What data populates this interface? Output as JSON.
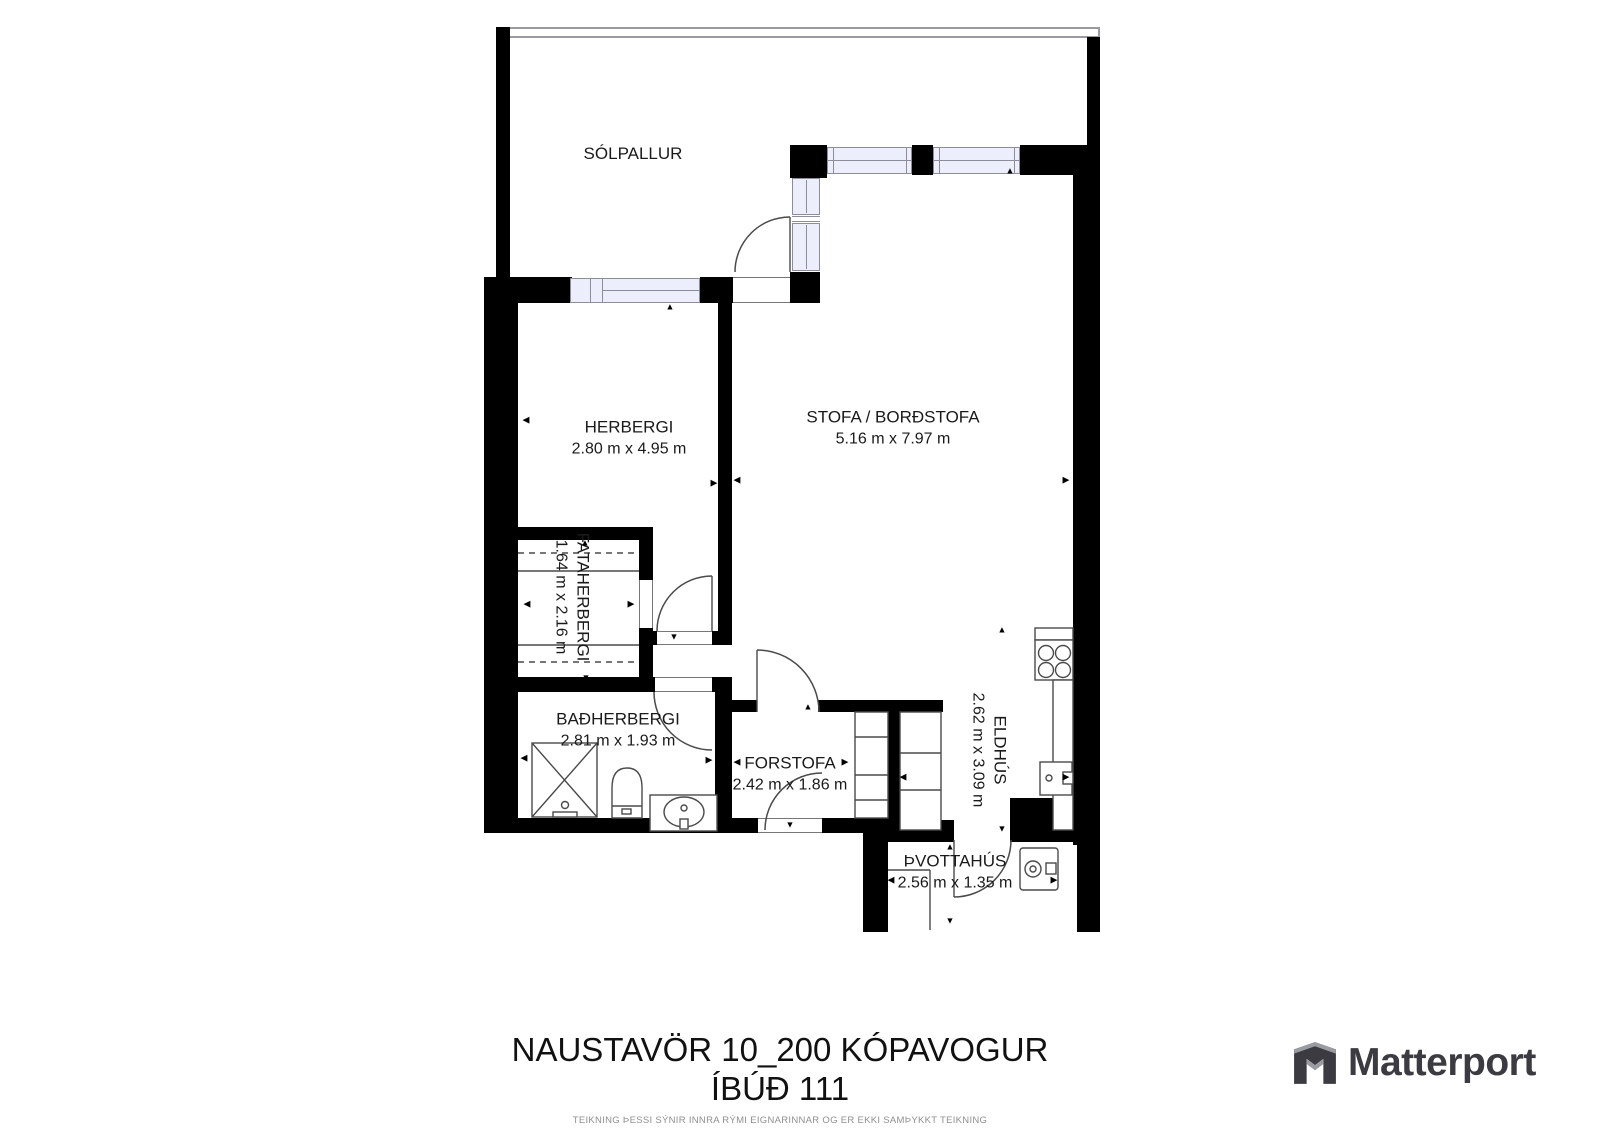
{
  "title": {
    "line1": "NAUSTAVÖR 10_200 KÓPAVOGUR",
    "line2": "ÍBÚÐ 111",
    "disclaimer": "TEIKNING ÞESSI SÝNIR INNRA RÝMI EIGNARINNAR OG ER EKKI SAMÞYKKT TEIKNING"
  },
  "brand": {
    "logo_text": "Matterport",
    "logo_icon": "matterport-cube-icon"
  },
  "colors": {
    "wall": "#000000",
    "window_fill": "#eceefb",
    "window_border": "#8d8d99",
    "stroke": "#4a4a4a",
    "label": "#1a1a1a",
    "disclaimer_text": "#8f8f8f",
    "logo": "#3b3b41",
    "logo_accent": "#9b9ba3"
  },
  "rooms": [
    {
      "id": "solpallur",
      "name": "SÓLPALLUR",
      "dims": "",
      "x": 633,
      "y": 154,
      "rot": 0
    },
    {
      "id": "herbergi",
      "name": "HERBERGI",
      "dims": "2.80 m x 4.95 m",
      "x": 629,
      "y": 438,
      "rot": 0
    },
    {
      "id": "stofa",
      "name": "STOFA / BORÐSTOFA",
      "dims": "5.16 m x 7.97 m",
      "x": 893,
      "y": 428,
      "rot": 0
    },
    {
      "id": "fataherbergi",
      "name": "FATAHERBERGI",
      "dims": "1.64 m x 2.16 m",
      "x": 572,
      "y": 597,
      "rot": 90
    },
    {
      "id": "badherbergi",
      "name": "BAÐHERBERGI",
      "dims": "2.81 m x 1.93 m",
      "x": 618,
      "y": 730,
      "rot": 0
    },
    {
      "id": "forstofa",
      "name": "FORSTOFA",
      "dims": "2.42 m x 1.86 m",
      "x": 790,
      "y": 774,
      "rot": 0
    },
    {
      "id": "eldhus",
      "name": "ELDHÚS",
      "dims": "2.62 m x 3.09 m",
      "x": 989,
      "y": 750,
      "rot": 90
    },
    {
      "id": "thvottahus",
      "name": "ÞVOTTAHÚS",
      "dims": "2.56 m x 1.35 m",
      "x": 955,
      "y": 872,
      "rot": 0
    }
  ],
  "plan": {
    "railing": {
      "x": 496,
      "y": 27,
      "w": 604,
      "h": 11
    },
    "walls": [
      {
        "x": 496,
        "y": 27,
        "w": 14,
        "h": 253
      },
      {
        "x": 1087,
        "y": 37,
        "w": 13,
        "h": 112
      },
      {
        "x": 484,
        "y": 277,
        "w": 34,
        "h": 556
      },
      {
        "x": 484,
        "y": 277,
        "w": 88,
        "h": 26
      },
      {
        "x": 700,
        "y": 277,
        "w": 33,
        "h": 26
      },
      {
        "x": 718,
        "y": 303,
        "w": 14,
        "h": 330
      },
      {
        "x": 645,
        "y": 631,
        "w": 87,
        "h": 14
      },
      {
        "x": 500,
        "y": 527,
        "w": 153,
        "h": 13
      },
      {
        "x": 639,
        "y": 540,
        "w": 14,
        "h": 40
      },
      {
        "x": 639,
        "y": 628,
        "w": 14,
        "h": 49
      },
      {
        "x": 500,
        "y": 677,
        "w": 155,
        "h": 15
      },
      {
        "x": 712,
        "y": 677,
        "w": 20,
        "h": 15
      },
      {
        "x": 715,
        "y": 692,
        "w": 17,
        "h": 128
      },
      {
        "x": 790,
        "y": 145,
        "w": 37,
        "h": 33
      },
      {
        "x": 912,
        "y": 145,
        "w": 21,
        "h": 30
      },
      {
        "x": 1020,
        "y": 145,
        "w": 80,
        "h": 30
      },
      {
        "x": 1073,
        "y": 145,
        "w": 27,
        "h": 700
      },
      {
        "x": 1077,
        "y": 845,
        "w": 23,
        "h": 87
      },
      {
        "x": 790,
        "y": 272,
        "w": 30,
        "h": 31
      },
      {
        "x": 732,
        "y": 700,
        "w": 25,
        "h": 12
      },
      {
        "x": 818,
        "y": 700,
        "w": 125,
        "h": 12
      },
      {
        "x": 888,
        "y": 712,
        "w": 12,
        "h": 110
      },
      {
        "x": 484,
        "y": 818,
        "w": 396,
        "h": 15
      },
      {
        "x": 863,
        "y": 810,
        "w": 25,
        "h": 122
      },
      {
        "x": 888,
        "y": 820,
        "w": 66,
        "h": 22
      },
      {
        "x": 1010,
        "y": 798,
        "w": 63,
        "h": 44
      }
    ],
    "windows": [
      {
        "x": 570,
        "y": 278,
        "w": 130,
        "h": 25
      },
      {
        "x": 827,
        "y": 147,
        "w": 85,
        "h": 27
      },
      {
        "x": 933,
        "y": 147,
        "w": 87,
        "h": 27
      },
      {
        "x": 792,
        "y": 178,
        "w": 28,
        "h": 37
      },
      {
        "x": 792,
        "y": 223,
        "w": 28,
        "h": 48
      }
    ],
    "window_lines": [
      {
        "x": 590,
        "y": 278,
        "w": 1,
        "h": 25
      },
      {
        "x": 602,
        "y": 278,
        "w": 1,
        "h": 25
      },
      {
        "x": 602,
        "y": 290,
        "w": 98,
        "h": 1
      },
      {
        "x": 833,
        "y": 147,
        "w": 1,
        "h": 27
      },
      {
        "x": 906,
        "y": 147,
        "w": 1,
        "h": 27
      },
      {
        "x": 827,
        "y": 160,
        "w": 85,
        "h": 1
      },
      {
        "x": 939,
        "y": 147,
        "w": 1,
        "h": 27
      },
      {
        "x": 1014,
        "y": 147,
        "w": 1,
        "h": 27
      },
      {
        "x": 933,
        "y": 160,
        "w": 87,
        "h": 1
      },
      {
        "x": 806,
        "y": 180,
        "w": 1,
        "h": 33
      },
      {
        "x": 806,
        "y": 225,
        "w": 1,
        "h": 44
      },
      {
        "x": 792,
        "y": 216,
        "w": 28,
        "h": 1
      },
      {
        "x": 792,
        "y": 221,
        "w": 28,
        "h": 1
      }
    ],
    "thresholds": [
      {
        "x": 657,
        "y": 631,
        "w": 55,
        "h": 14,
        "o": "h"
      },
      {
        "x": 655,
        "y": 677,
        "w": 57,
        "h": 15,
        "o": "h"
      },
      {
        "x": 758,
        "y": 818,
        "w": 64,
        "h": 15,
        "o": "h"
      },
      {
        "x": 639,
        "y": 580,
        "w": 14,
        "h": 48,
        "o": "v"
      },
      {
        "x": 733,
        "y": 277,
        "w": 57,
        "h": 26,
        "o": "h"
      }
    ],
    "arcs": [
      {
        "d": "M735,272 A55,55 0 0 1 790,217"
      },
      {
        "d": "M657,631 A55,55 0 0 1 712,576"
      },
      {
        "d": "M654,692 A58,58 0 0 0 712,750"
      },
      {
        "d": "M757,650 A62,62 0 0 1 819,712"
      },
      {
        "d": "M765,830 A57,57 0 0 1 822,773"
      },
      {
        "d": "M1011,840 A57,57 0 0 1 954,897"
      }
    ],
    "fixtures": [
      {
        "t": "line",
        "x1": 790,
        "y1": 217,
        "x2": 790,
        "y2": 272
      },
      {
        "t": "line",
        "x1": 712,
        "y1": 576,
        "x2": 712,
        "y2": 631
      },
      {
        "t": "line",
        "x1": 757,
        "y1": 650,
        "x2": 757,
        "y2": 712
      },
      {
        "t": "line",
        "x1": 954,
        "y1": 840,
        "x2": 954,
        "y2": 897
      },
      {
        "t": "rect",
        "x": 532,
        "y": 743,
        "w": 65,
        "h": 74,
        "f": "none"
      },
      {
        "t": "line",
        "x1": 532,
        "y1": 743,
        "x2": 597,
        "y2": 817
      },
      {
        "t": "line",
        "x1": 597,
        "y1": 743,
        "x2": 532,
        "y2": 817
      },
      {
        "t": "circle",
        "cx": 565,
        "cy": 805,
        "r": 3.5,
        "f": "#fff"
      },
      {
        "t": "rect",
        "x": 553,
        "y": 812,
        "w": 24,
        "h": 5,
        "f": "#fff"
      },
      {
        "t": "path",
        "d": "M612,818 L612,788 Q612,768 627,768 Q642,768 642,788 L642,818 Z",
        "f": "#fff"
      },
      {
        "t": "line",
        "x1": 612,
        "y1": 806,
        "x2": 642,
        "y2": 806
      },
      {
        "t": "rect",
        "x": 622,
        "y": 809,
        "w": 9,
        "h": 5,
        "f": "#fff"
      },
      {
        "t": "rect",
        "x": 650,
        "y": 795,
        "w": 67,
        "h": 36,
        "f": "#fff"
      },
      {
        "t": "ellipse",
        "cx": 684,
        "cy": 812,
        "rx": 20,
        "ry": 15,
        "f": "#fff"
      },
      {
        "t": "circle",
        "cx": 684,
        "cy": 808,
        "r": 3,
        "f": "#fff"
      },
      {
        "t": "rect",
        "x": 680,
        "y": 819,
        "w": 8,
        "h": 10,
        "f": "#fff"
      },
      {
        "t": "rect",
        "x": 1035,
        "y": 628,
        "w": 38,
        "h": 12,
        "f": "#fff"
      },
      {
        "t": "rect",
        "x": 1035,
        "y": 640,
        "w": 38,
        "h": 40,
        "f": "#fff"
      },
      {
        "t": "circle",
        "cx": 1046,
        "cy": 653,
        "r": 7.5,
        "f": "#fff"
      },
      {
        "t": "circle",
        "cx": 1063,
        "cy": 653,
        "r": 7.5,
        "f": "#fff"
      },
      {
        "t": "circle",
        "cx": 1046,
        "cy": 670,
        "r": 7.5,
        "f": "#fff"
      },
      {
        "t": "circle",
        "cx": 1063,
        "cy": 670,
        "r": 7.5,
        "f": "#fff"
      },
      {
        "t": "rect",
        "x": 1053,
        "y": 680,
        "w": 20,
        "h": 150,
        "f": "#fff"
      },
      {
        "t": "rect",
        "x": 1040,
        "y": 762,
        "w": 32,
        "h": 33,
        "f": "#fff"
      },
      {
        "t": "circle",
        "cx": 1049,
        "cy": 778,
        "r": 3,
        "f": "#fff"
      },
      {
        "t": "rect",
        "x": 1063,
        "y": 772,
        "w": 10,
        "h": 12,
        "f": "#fff"
      },
      {
        "t": "rect",
        "x": 900,
        "y": 712,
        "w": 41,
        "h": 118,
        "f": "#fff"
      },
      {
        "t": "line",
        "x1": 900,
        "y1": 753,
        "x2": 941,
        "y2": 753
      },
      {
        "t": "line",
        "x1": 900,
        "y1": 790,
        "x2": 941,
        "y2": 790
      },
      {
        "t": "rect",
        "x": 855,
        "y": 712,
        "w": 33,
        "h": 106,
        "f": "#fff"
      },
      {
        "t": "line",
        "x1": 855,
        "y1": 737,
        "x2": 888,
        "y2": 737
      },
      {
        "t": "line",
        "x1": 855,
        "y1": 775,
        "x2": 888,
        "y2": 775
      },
      {
        "t": "line",
        "x1": 855,
        "y1": 800,
        "x2": 888,
        "y2": 800
      },
      {
        "t": "rect",
        "x": 1020,
        "y": 848,
        "w": 38,
        "h": 42,
        "rx": 3,
        "f": "#fff"
      },
      {
        "t": "circle",
        "cx": 1033,
        "cy": 869,
        "r": 8,
        "f": "#fff"
      },
      {
        "t": "circle",
        "cx": 1033,
        "cy": 869,
        "r": 3,
        "f": "#fff"
      },
      {
        "t": "rect",
        "x": 1046,
        "y": 863,
        "w": 10,
        "h": 11,
        "f": "#fff"
      },
      {
        "t": "line",
        "x1": 888,
        "y1": 870,
        "x2": 930,
        "y2": 870
      },
      {
        "t": "line",
        "x1": 930,
        "y1": 870,
        "x2": 930,
        "y2": 930
      },
      {
        "t": "line",
        "x1": 518,
        "y1": 553,
        "x2": 639,
        "y2": 553,
        "dash": "6,5"
      },
      {
        "t": "line",
        "x1": 518,
        "y1": 571,
        "x2": 639,
        "y2": 571
      },
      {
        "t": "line",
        "x1": 518,
        "y1": 645,
        "x2": 639,
        "y2": 645
      },
      {
        "t": "line",
        "x1": 518,
        "y1": 662,
        "x2": 639,
        "y2": 662,
        "dash": "6,5"
      }
    ],
    "arrows": [
      {
        "g": "up",
        "x": 670,
        "y": 307
      },
      {
        "g": "up",
        "x": 1010,
        "y": 171
      },
      {
        "g": "up",
        "x": 808,
        "y": 707
      },
      {
        "g": "up",
        "x": 950,
        "y": 847
      },
      {
        "g": "up",
        "x": 1002,
        "y": 630
      },
      {
        "g": "up",
        "x": 585,
        "y": 543
      },
      {
        "g": "down",
        "x": 674,
        "y": 637
      },
      {
        "g": "down",
        "x": 790,
        "y": 825
      },
      {
        "g": "down",
        "x": 950,
        "y": 921
      },
      {
        "g": "down",
        "x": 1002,
        "y": 829
      },
      {
        "g": "down",
        "x": 586,
        "y": 678
      },
      {
        "g": "left",
        "x": 526,
        "y": 420
      },
      {
        "g": "left",
        "x": 527,
        "y": 604
      },
      {
        "g": "left",
        "x": 737,
        "y": 480
      },
      {
        "g": "left",
        "x": 524,
        "y": 758
      },
      {
        "g": "left",
        "x": 737,
        "y": 762
      },
      {
        "g": "left",
        "x": 891,
        "y": 880
      },
      {
        "g": "left",
        "x": 903,
        "y": 777
      },
      {
        "g": "right",
        "x": 714,
        "y": 483
      },
      {
        "g": "right",
        "x": 631,
        "y": 604
      },
      {
        "g": "right",
        "x": 1066,
        "y": 480
      },
      {
        "g": "right",
        "x": 709,
        "y": 760
      },
      {
        "g": "right",
        "x": 845,
        "y": 762
      },
      {
        "g": "right",
        "x": 1054,
        "y": 880
      },
      {
        "g": "right",
        "x": 1066,
        "y": 777
      }
    ]
  }
}
